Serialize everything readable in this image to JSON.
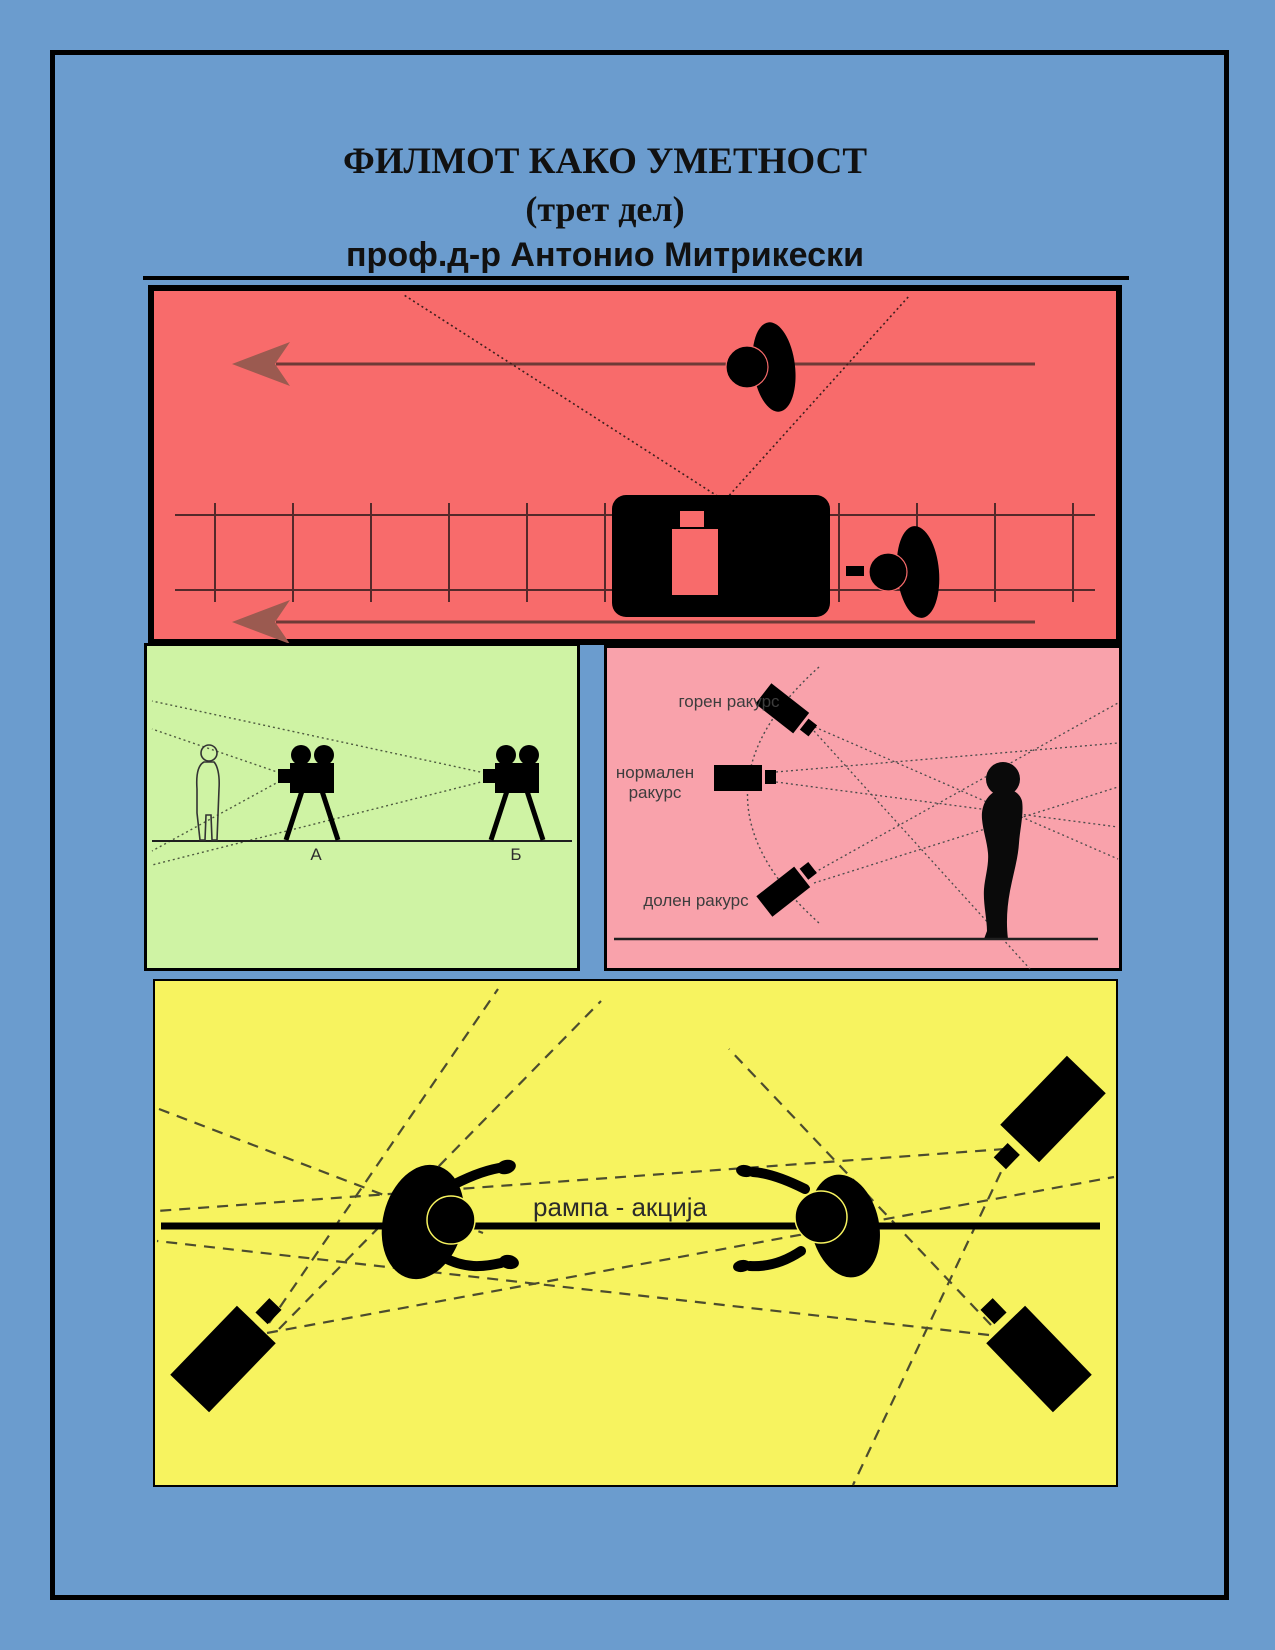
{
  "title": {
    "line1": "ФИЛМОТ КАКО УМЕТНОСТ",
    "line2": "(трет дел)",
    "line3": "проф.д-р Антонио Митрикески"
  },
  "panels": {
    "dolly_shot": {
      "background_color": "#f86b6b",
      "icons": [
        "walking-person-top-view",
        "direction-arrow-left",
        "dolly-track",
        "camera-cart",
        "camera-operator-top-view"
      ]
    },
    "two_camera_positions": {
      "background_color": "#cff3a4",
      "camera_a_label": "А",
      "camera_b_label": "Б"
    },
    "camera_angles": {
      "background_color": "#f9a2ab",
      "high_angle_label": "горен ракурс",
      "normal_angle_label_line1": "нормален",
      "normal_angle_label_line2": "ракурс",
      "low_angle_label": "долен ракурс"
    },
    "action_axis": {
      "background_color": "#f7f35f",
      "axis_label": "рампа - акција"
    }
  },
  "colors": {
    "page_background": "#6b9cce",
    "border": "#000000",
    "arrow_brown": "#9b5a50",
    "track_line": "#54292a"
  }
}
